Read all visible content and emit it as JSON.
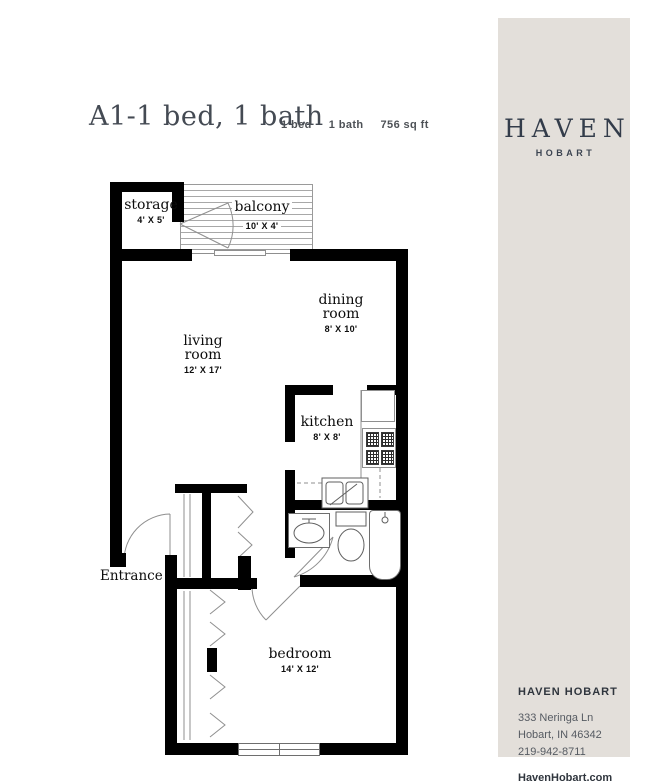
{
  "header": {
    "title": "A1-1 bed, 1 bath",
    "stats": [
      {
        "label": "1 bed"
      },
      {
        "label": "1 bath"
      },
      {
        "label": "756 sq ft"
      }
    ]
  },
  "floorplan": {
    "wall_color": "#000000",
    "line_color": "#8f8f8f",
    "entrance_label": "Entrance",
    "rooms": {
      "storage": {
        "name": "storage",
        "dims": "4' X 5'"
      },
      "balcony": {
        "name": "balcony",
        "dims": "10' X 4'"
      },
      "dining": {
        "name": "dining room",
        "dims": "8' X 10'"
      },
      "living": {
        "name": "living room",
        "dims": "12' X 17'"
      },
      "kitchen": {
        "name": "kitchen",
        "dims": "8' X 8'"
      },
      "bedroom": {
        "name": "bedroom",
        "dims": "14' X 12'"
      }
    }
  },
  "sidebar": {
    "bg_color": "#e3dfda",
    "text_color": "#333c4a",
    "logo": {
      "name": "HAVEN",
      "location": "HOBART"
    },
    "footer": {
      "heading": "HAVEN HOBART",
      "address_line1": "333 Neringa Ln",
      "address_line2": "Hobart, IN 46342",
      "phone": "219-942-8711",
      "website": "HavenHobart.com"
    }
  }
}
